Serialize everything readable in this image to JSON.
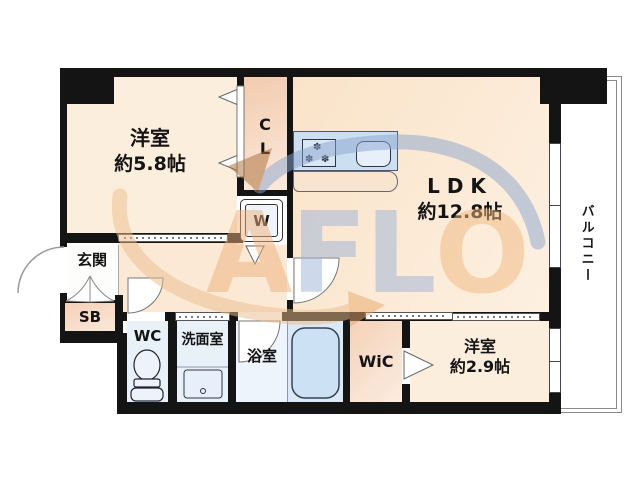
{
  "floor_plan": {
    "rooms": {
      "bedroom_main": {
        "label": "洋室",
        "size": "約5.8帖"
      },
      "closet": {
        "label_top": "C",
        "label_bottom": "L"
      },
      "laundry": {
        "label": "W"
      },
      "ldk": {
        "label": "LDK",
        "size": "約12.8帖"
      },
      "balcony": {
        "label": "バルコニー"
      },
      "entrance": {
        "label": "玄関"
      },
      "shoe_box": {
        "label": "SB"
      },
      "toilet": {
        "label": "WC"
      },
      "washroom": {
        "label": "洗面室"
      },
      "bathroom": {
        "label": "浴室"
      },
      "walk_in_closet": {
        "label": "WiC"
      },
      "bedroom_small": {
        "label": "洋室",
        "size": "約2.9帖"
      }
    },
    "kitchen": {
      "burner_glyph": "✽"
    },
    "watermark": {
      "text": "AFLO",
      "letters": [
        {
          "char": "A",
          "color": "#eeb07c"
        },
        {
          "char": "F",
          "color": "#9db4d8"
        },
        {
          "char": "L",
          "color": "#9db4d8"
        },
        {
          "char": "O",
          "color": "#f0b87f"
        }
      ],
      "arc_blue": "#8aa5cf",
      "arc_orange": "#edbd8d",
      "arrow_dark": "#a86a33",
      "arrow_orange": "#e9a86a"
    },
    "colors": {
      "wall": "#141414",
      "room_warm": "#fceedd",
      "hallway": "#fbe9d6",
      "closet_gradient": "#f2cbae",
      "wet_room": "#e8f0f8",
      "bath_right": "#dbe9f6",
      "fixture_blue": "#cde1f4",
      "kitchen_counter": "#ccdef1"
    }
  }
}
